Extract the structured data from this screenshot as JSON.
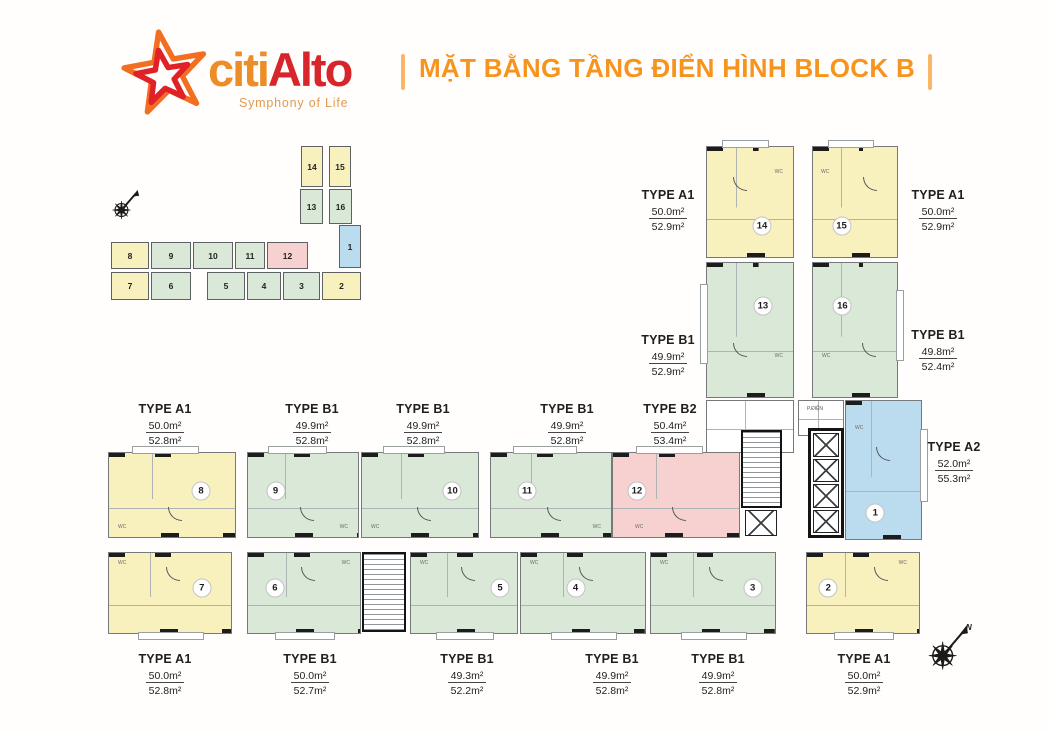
{
  "header": {
    "brand": {
      "part1": "citi",
      "part2": "Alto",
      "tagline": "Symphony of Life"
    },
    "title": "MẶT BẰNG TẦNG ĐIỂN HÌNH BLOCK B"
  },
  "colors": {
    "unit_yellow": "#f9f1bd",
    "unit_green": "#d9e8d7",
    "unit_pink": "#f6d1d0",
    "unit_blue": "#badcee",
    "brand_orange": "#ee8d27",
    "brand_red": "#d8242b",
    "title_orange": "#f6941e"
  },
  "minimap": {
    "units": [
      {
        "number": "14"
      },
      {
        "number": "15"
      },
      {
        "number": "13"
      },
      {
        "number": "16"
      },
      {
        "number": "1"
      },
      {
        "number": "8"
      },
      {
        "number": "9"
      },
      {
        "number": "10"
      },
      {
        "number": "11"
      },
      {
        "number": "12"
      },
      {
        "number": "7"
      },
      {
        "number": "6"
      },
      {
        "number": "5"
      },
      {
        "number": "4"
      },
      {
        "number": "3"
      },
      {
        "number": "2"
      }
    ]
  },
  "plan": {
    "wc_label": "WC",
    "electrical_room_label": "P.ĐIỆN",
    "units": {
      "u1": "1",
      "u2": "2",
      "u3": "3",
      "u4": "4",
      "u5": "5",
      "u6": "6",
      "u7": "7",
      "u8": "8",
      "u9": "9",
      "u10": "10",
      "u11": "11",
      "u12": "12",
      "u13": "13",
      "u14": "14",
      "u15": "15",
      "u16": "16"
    },
    "labels": [
      {
        "type": "TYPE A1",
        "area1": "50.0m²",
        "area2": "52.9m²"
      },
      {
        "type": "TYPE A1",
        "area1": "50.0m²",
        "area2": "52.9m²"
      },
      {
        "type": "TYPE B1",
        "area1": "49.9m²",
        "area2": "52.9m²"
      },
      {
        "type": "TYPE B1",
        "area1": "49.8m²",
        "area2": "52.4m²"
      },
      {
        "type": "TYPE A1",
        "area1": "50.0m²",
        "area2": "52.8m²"
      },
      {
        "type": "TYPE B1",
        "area1": "49.9m²",
        "area2": "52.8m²"
      },
      {
        "type": "TYPE B1",
        "area1": "49.9m²",
        "area2": "52.8m²"
      },
      {
        "type": "TYPE B1",
        "area1": "49.9m²",
        "area2": "52.8m²"
      },
      {
        "type": "TYPE B2",
        "area1": "50.4m²",
        "area2": "53.4m²"
      },
      {
        "type": "TYPE A2",
        "area1": "52.0m²",
        "area2": "55.3m²"
      },
      {
        "type": "TYPE A1",
        "area1": "50.0m²",
        "area2": "52.8m²"
      },
      {
        "type": "TYPE B1",
        "area1": "50.0m²",
        "area2": "52.7m²"
      },
      {
        "type": "TYPE B1",
        "area1": "49.3m²",
        "area2": "52.2m²"
      },
      {
        "type": "TYPE B1",
        "area1": "49.9m²",
        "area2": "52.8m²"
      },
      {
        "type": "TYPE B1",
        "area1": "49.9m²",
        "area2": "52.8m²"
      },
      {
        "type": "TYPE A1",
        "area1": "50.0m²",
        "area2": "52.9m²"
      }
    ]
  },
  "compass": {
    "north": "N"
  }
}
